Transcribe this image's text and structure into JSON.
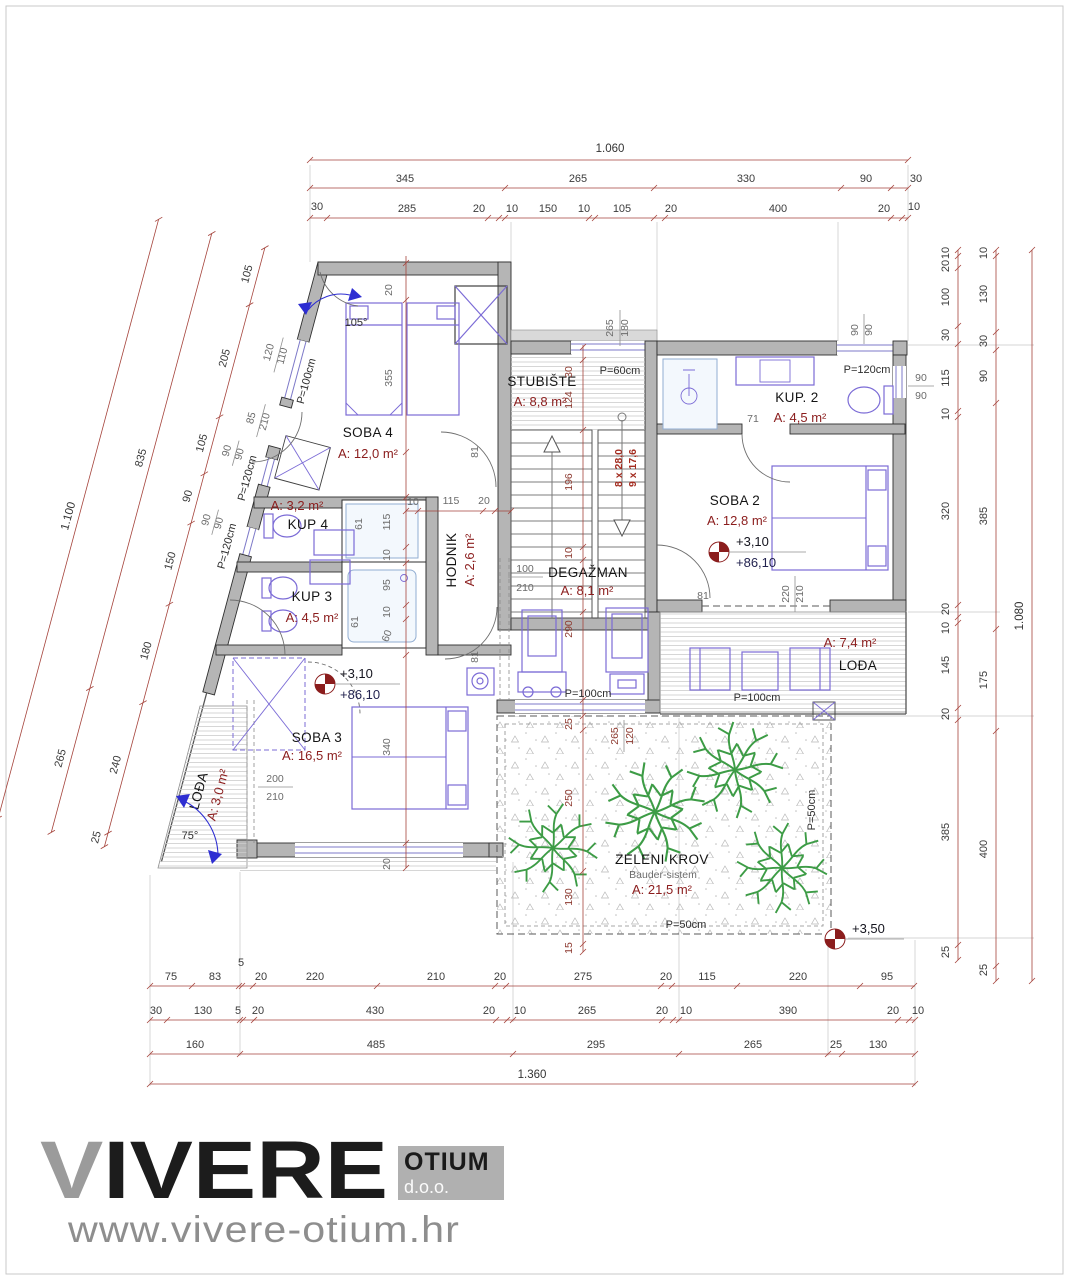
{
  "logo": {
    "brand_first": "V",
    "brand_rest": "IVERE",
    "box_title": "OTIUM",
    "box_sub": "d.o.o.",
    "website": "www.vivere-otium.hr"
  },
  "rooms": [
    {
      "name": "SOBA 4",
      "area": "A: 12,0 m²"
    },
    {
      "name": "STUBIŠTE",
      "area": "A: 8,8 m²"
    },
    {
      "name": "KUP. 2",
      "area": "A: 4,5 m²"
    },
    {
      "name": "SOBA 2",
      "area": "A: 12,8 m²"
    },
    {
      "name": "KUP 4",
      "area": "A: 3,2 m²"
    },
    {
      "name": "KUP 3",
      "area": "A: 4,5 m²"
    },
    {
      "name": "HODNIK",
      "area": "A: 2,6 m²"
    },
    {
      "name": "DEGAŽMAN",
      "area": "A: 8,1 m²"
    },
    {
      "name": "SOBA 3",
      "area": "A: 16,5 m²"
    },
    {
      "name": "LOĐA",
      "area": "A: 3,0 m²"
    },
    {
      "name": "LOĐA",
      "area": "A: 7,4 m²"
    },
    {
      "name": "ZELENI KROV",
      "sub": "Bauder-sistem",
      "area": "A: 21,5 m²"
    }
  ],
  "levels": {
    "plus310": "+3,10",
    "plus8610": "+86,10",
    "plus350": "+3,50"
  },
  "stairs": {
    "run_up": "8 x 28,0",
    "run_down": "9 x 17,6"
  },
  "parapets": {
    "p60": "P=60cm",
    "p100": "P=100cm",
    "p120": "P=120cm",
    "p50": "P=50cm"
  },
  "angles": {
    "top": "105°",
    "bottom": "75°"
  },
  "doors": {
    "d81": "81",
    "d71": "71",
    "d61": "61",
    "d60": "60"
  },
  "fractions": {
    "win_soba4": [
      "120",
      "110"
    ],
    "door_left": [
      "85",
      "210"
    ],
    "win_kup4": [
      "90",
      "90"
    ],
    "win_kup3": [
      "90",
      "90"
    ],
    "win_top": [
      "265",
      "180"
    ],
    "win_kup2_top": [
      "90",
      "90"
    ],
    "win_kup2_right": [
      "90",
      "90"
    ],
    "door_deg": [
      "100",
      "210"
    ],
    "door_soba2": [
      "220",
      "210"
    ],
    "door_soba3": [
      "200",
      "210"
    ],
    "roof_top": [
      "265",
      "120"
    ]
  },
  "inner": {
    "soba4_wall": "20",
    "soba4_bed": "355",
    "shaft_61a": "61",
    "shaft_115": "115",
    "shaft_10a": "10",
    "shaft_95": "95",
    "shaft_10b": "10",
    "shaft_61b": "61",
    "shaft_60": "60",
    "hod_10": "10",
    "hod_115": "115",
    "hod_20": "20",
    "st_30": "30",
    "st_124": "124",
    "st_196": "196",
    "st_10": "10",
    "deg_290": "290",
    "soba3_bed": "340",
    "soba3_20": "20",
    "roof_25": "25",
    "roof_250": "250",
    "roof_130": "130",
    "roof_15": "15"
  },
  "dims": {
    "top": {
      "total": "1.060",
      "row2": [
        "345",
        "265",
        "330",
        "90",
        "30"
      ],
      "row3": [
        "30",
        "285",
        "20",
        "10",
        "150",
        "10",
        "105",
        "20",
        "400",
        "20",
        "10"
      ]
    },
    "bottom": {
      "row1": [
        "75",
        "83",
        "5",
        "20",
        "220",
        "210",
        "20",
        "275",
        "20",
        "115",
        "220",
        "95"
      ],
      "row2": [
        "30",
        "130",
        "5",
        "20",
        "430",
        "20",
        "10",
        "265",
        "20",
        "10",
        "390",
        "20",
        "10"
      ],
      "row3": [
        "160",
        "485",
        "295",
        "265",
        "25",
        "130"
      ],
      "total": "1.360"
    },
    "left": {
      "total": "1.100",
      "mid": [
        "835",
        "265"
      ],
      "inner": [
        "105",
        "205",
        "105",
        "90",
        "150",
        "180",
        "240",
        "25"
      ]
    },
    "right": {
      "total": "1.080",
      "inner": [
        "10",
        "20",
        "100",
        "30",
        "115",
        "10",
        "320",
        "20",
        "10",
        "145",
        "20",
        "385",
        "25"
      ],
      "mid": [
        "10",
        "130",
        "30",
        "90",
        "385",
        "175",
        "400",
        "25"
      ]
    }
  }
}
